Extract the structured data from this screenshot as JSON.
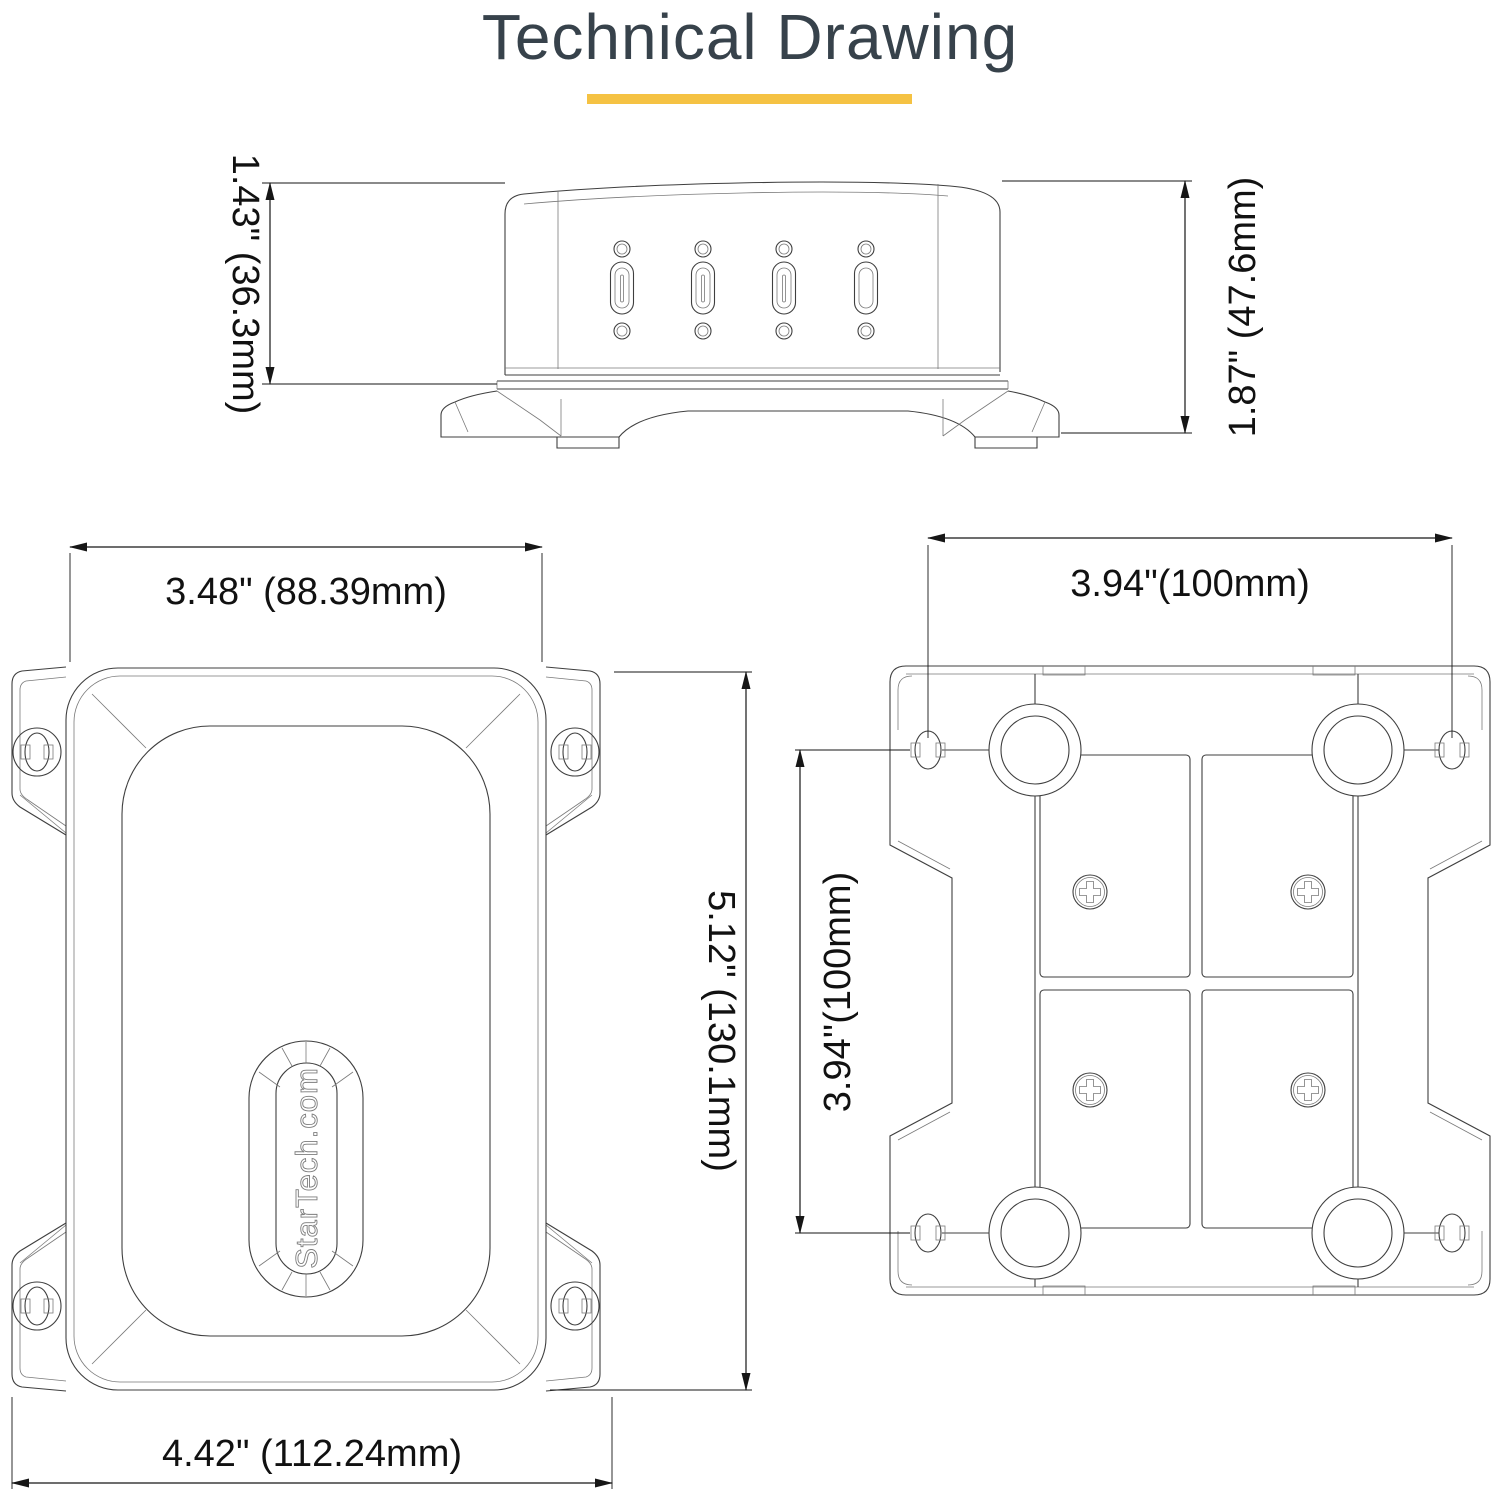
{
  "title": "Technical Drawing",
  "accent_color": "#F5C243",
  "logo": {
    "text": "StarTech.com"
  },
  "views": {
    "side": {
      "description": "front-facing side elevation with four USB-C ports on mounting base",
      "dim_body_height": "1.43\" (36.3mm)",
      "dim_total_height": "1.87\" (47.6mm)",
      "port_count": "4"
    },
    "front": {
      "description": "front face with StarTech.com logo and four flange mounting ears",
      "dim_width": "3.48\" (88.39mm)",
      "dim_height": "5.12\" (130.1mm)",
      "dim_total_width": "4.42\" (112.24mm)"
    },
    "back": {
      "description": "rear mounting plate with VESA bosses and four screws",
      "dim_hole_spacing_x": "3.94\"(100mm)",
      "dim_hole_spacing_y": "3.94''(100mm)"
    }
  }
}
